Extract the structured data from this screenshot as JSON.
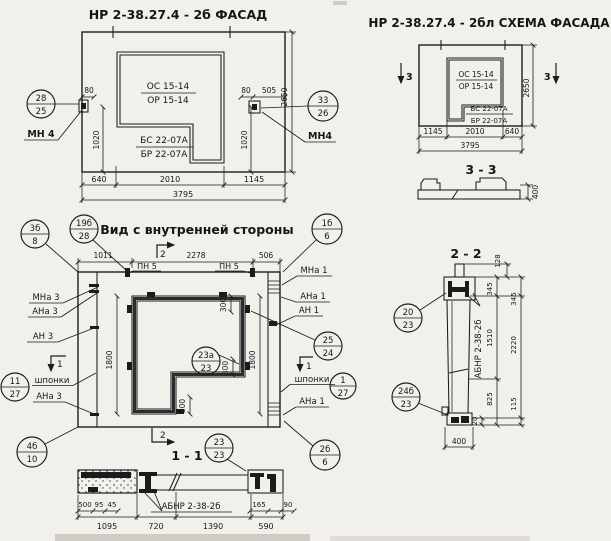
{
  "facade": {
    "title": "НР 2-38.27.4 - 2б  ФАСАД",
    "opening_top": "ОС 15-14",
    "opening_bottom": "ОР 15-14",
    "block_top": "БС 22-07А",
    "block_bottom": "БР 22-07А",
    "callout_left_top": "28",
    "callout_left_bottom": "25",
    "callout_left_label": "МН 4",
    "callout_right_top": "33",
    "callout_right_bottom": "26",
    "callout_right_label": "МН4",
    "dim_80_left": "80",
    "dim_1020_left": "1020",
    "dim_80_right": "80",
    "dim_505": "505",
    "dim_1020_right": "1020",
    "dim_2650": "2650",
    "dim_640": "640",
    "dim_2010": "2010",
    "dim_1145": "1145",
    "dim_total": "3795"
  },
  "schema": {
    "title": "НР 2-38.27.4 - 2бл СХЕМА ФАСАДА",
    "opening_top": "ОС 15-14",
    "opening_bottom": "ОР 15-14",
    "block_top": "БС 22-07А",
    "block_bottom": "БР 22-07А",
    "mark_left": "3",
    "mark_right": "3",
    "dim_2650": "2650",
    "dim_1145": "1145",
    "dim_2010": "2010",
    "dim_640": "640",
    "dim_total": "3795"
  },
  "section33": {
    "title": "3 - 3",
    "dim_400": "400"
  },
  "inner": {
    "title": "Вид с внутренней стороны",
    "callout_3b_top": "3б",
    "callout_3b_bottom": "8",
    "callout_19b_top": "19б",
    "callout_19b_bottom": "28",
    "callout_1b_top": "1б",
    "callout_1b_bottom": "6",
    "mark_2_top": "2",
    "mark_2_bottom": "2",
    "mark_1_left": "1",
    "mark_1_right": "1",
    "dim_1011": "1011",
    "dim_2278": "2278",
    "dim_506": "506",
    "pn5_left": "ПН 5",
    "pn5_right": "ПН 5",
    "mna3": "МНа 3",
    "ana3_top": "АНа 3",
    "an3": "АН 3",
    "shponki_left": "шпонки",
    "callout_11_top": "11",
    "callout_11_bottom": "27",
    "ana3_bottom": "АНа 3",
    "callout_4b_top": "4б",
    "callout_4b_bottom": "10",
    "mna1": "МНа 1",
    "ana1_top": "АНа 1",
    "an1": "АН 1",
    "callout_25_top": "25",
    "callout_25_bottom": "24",
    "shponki_right": "шпонки",
    "callout_1_top": "1",
    "callout_1_bottom": "27",
    "ana1_bottom": "АНа 1",
    "callout_2b_top": "2б",
    "callout_2b_bottom": "6",
    "dim_1800_left": "1800",
    "dim_1800_right": "1800",
    "dim_300_top": "300",
    "dim_300_mid": "300",
    "dim_300_bottom": "300",
    "callout_23a_top": "23а",
    "callout_23a_bottom": "23",
    "callout_23_top": "23",
    "callout_23_bottom": "23"
  },
  "section11": {
    "title": "1 - 1",
    "label": "АБНР 2-38-2б",
    "dim_500": "500",
    "dim_95": "95",
    "dim_45": "45",
    "dim_165": "165",
    "dim_90": "90",
    "dim_1095": "1095",
    "dim_720": "720",
    "dim_1390": "1390",
    "dim_590": "590"
  },
  "section22": {
    "title": "2 - 2",
    "label": "АБНР 2-38-2б",
    "callout_20_top": "20",
    "callout_20_bottom": "23",
    "callout_24b_top": "24б",
    "callout_24b_bottom": "23",
    "dim_128": "128",
    "dim_345_inner": "345",
    "dim_345_outer": "345",
    "dim_1510": "1510",
    "dim_2220": "2220",
    "dim_825": "825",
    "dim_115": "115",
    "dim_20": "20",
    "dim_400": "400"
  }
}
